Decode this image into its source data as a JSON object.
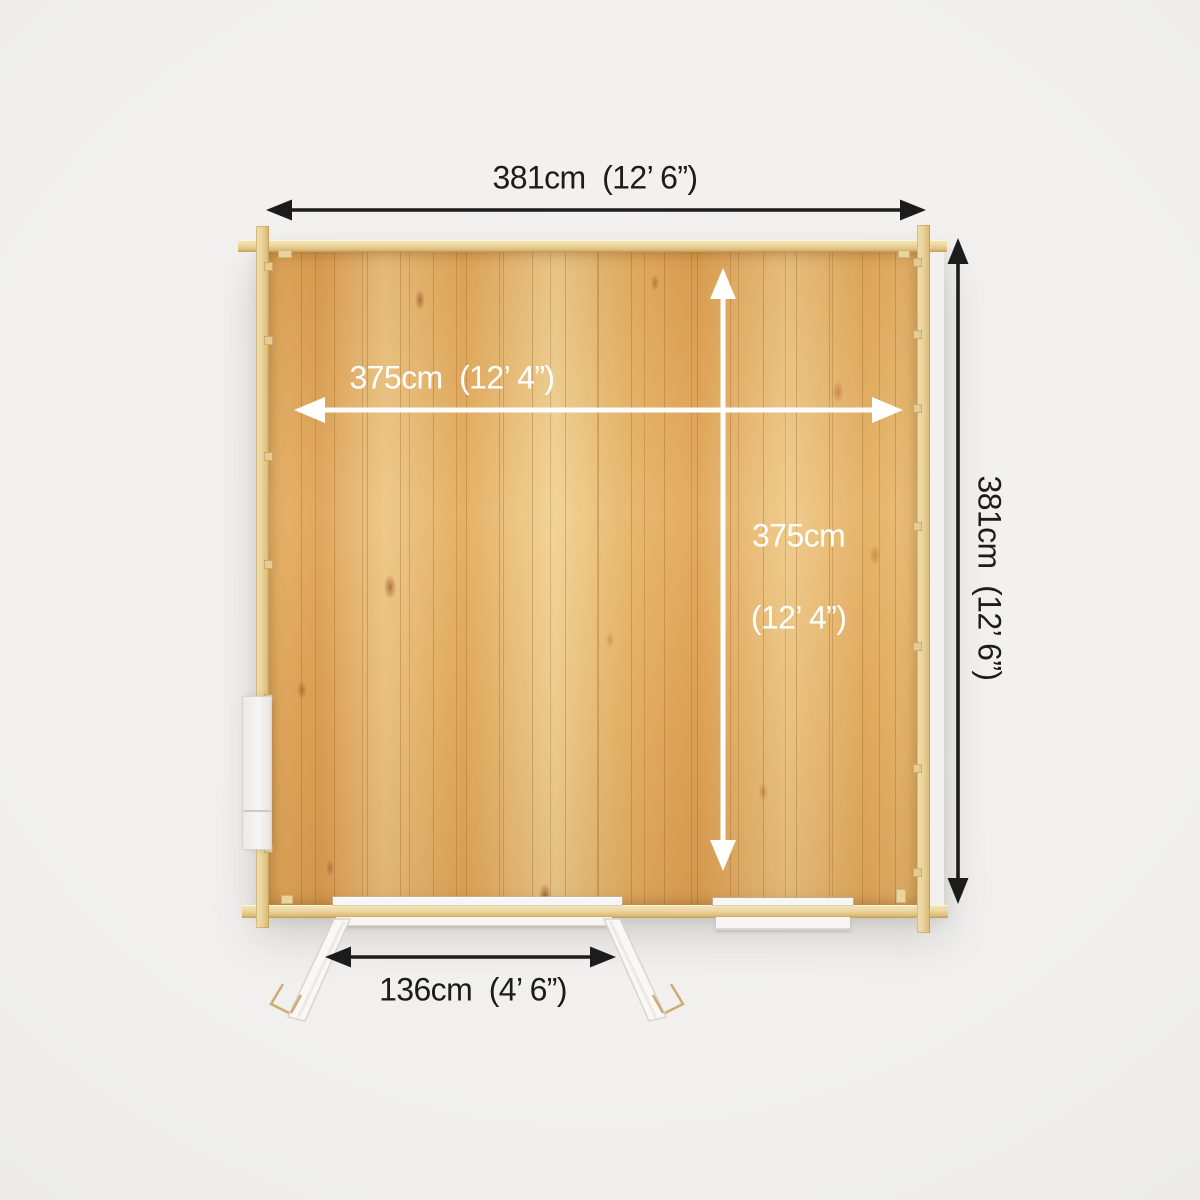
{
  "colors": {
    "dimension_dark": "#1c1c1c",
    "dimension_light": "#ffffff",
    "background": "#f1f0ee",
    "wood_beam": "#e9d3a0",
    "wood_floor": "#e3ac60",
    "joinery_white": "#f7f6f4"
  },
  "dimensions": {
    "overall_width": "381cm  (12’ 6”)",
    "overall_depth": "381cm  (12’ 6”)",
    "internal_width": "375cm  (12’ 4”)",
    "internal_depth_line1": "375cm",
    "internal_depth_line2": "(12’ 4”)",
    "door_width": "136cm  (4’ 6”)"
  }
}
